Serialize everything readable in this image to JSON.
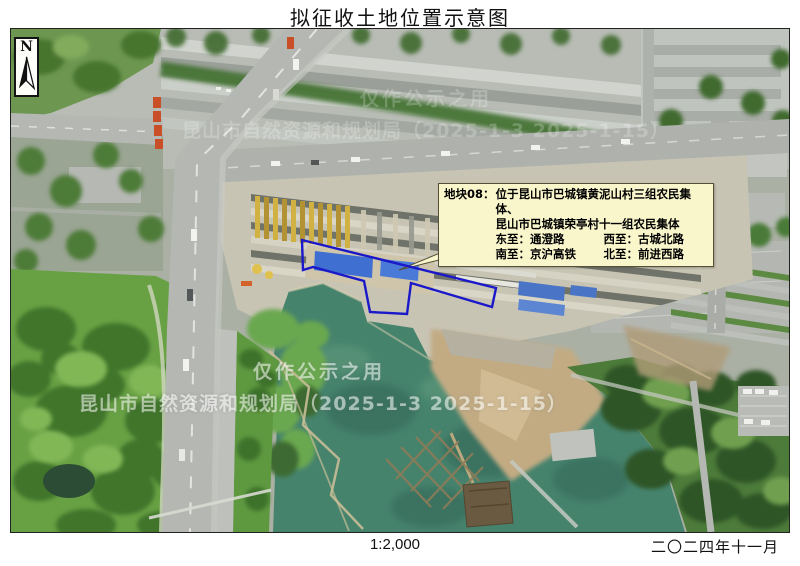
{
  "page": {
    "title": "拟征收土地位置示意图",
    "scale_label": "1:2,000",
    "date_label": "二〇二四年十一月"
  },
  "north_arrow": {
    "label": "N"
  },
  "callout": {
    "plot_label": "地块08：",
    "location_line1": "位于昆山市巴城镇黄泥山村三组农民集体、",
    "location_line2": "昆山市巴城镇荣亭村十一组农民集体",
    "east": "东至：通澄路",
    "west": "西至：古城北路",
    "south": "南至：京沪高铁",
    "north": "北至：前进西路"
  },
  "watermark": {
    "line1": "仅作公示之用",
    "line2": "昆山市自然资源和规划局（2025-1-3 2025-1-15）"
  },
  "colors": {
    "plot_outline": "#1a18c8",
    "callout_bg": "#f9f6cb",
    "lake": "#46836d",
    "park_green": "#68a144"
  }
}
